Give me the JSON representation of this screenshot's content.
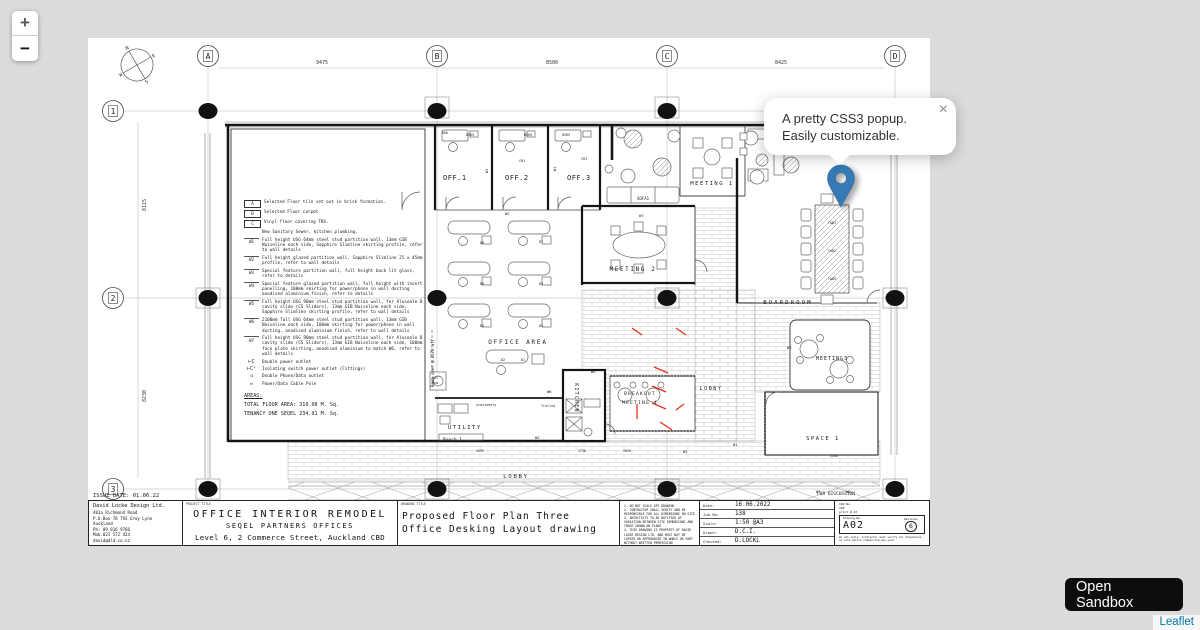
{
  "colors": {
    "map_bg": "#dcdcdc",
    "marker": "#3579b5",
    "attribution_link": "#0078A8",
    "red_mark": "#e8311a"
  },
  "ui": {
    "zoom_in": "+",
    "zoom_out": "−",
    "popup": {
      "line1": "A pretty CSS3 popup.",
      "line2": "Easily customizable.",
      "close": "×"
    },
    "sandbox_label": "Open Sandbox",
    "attribution": "Leaflet"
  },
  "plan": {
    "grid": {
      "cols": [
        {
          "label": "A",
          "x": 120
        },
        {
          "label": "B",
          "x": 349
        },
        {
          "label": "C",
          "x": 579
        },
        {
          "label": "D",
          "x": 807
        }
      ],
      "rows": [
        {
          "label": "1",
          "y": 73
        },
        {
          "label": "2",
          "y": 260
        },
        {
          "label": "3",
          "y": 451
        }
      ],
      "col_dims": [
        {
          "text": "9475",
          "x": 234
        },
        {
          "text": "8500",
          "x": 464
        },
        {
          "text": "8425",
          "x": 693
        }
      ],
      "row_dims": [
        {
          "text": "8115",
          "y": 167
        },
        {
          "text": "8230",
          "y": 358
        }
      ]
    },
    "compass": {
      "n": "N",
      "e": "E",
      "s": "S",
      "w": "W"
    },
    "labels": [
      {
        "t": "OFF.1",
        "x": 355,
        "y": 142,
        "s": 7,
        "ls": 0.5
      },
      {
        "t": "OFF.2",
        "x": 417,
        "y": 142,
        "s": 7,
        "ls": 0.5
      },
      {
        "t": "OFF.3",
        "x": 479,
        "y": 142,
        "s": 7,
        "ls": 0.5
      },
      {
        "t": "MEETING 1",
        "x": 624,
        "y": 147,
        "s": 5.5,
        "ls": 1.5,
        "a": "middle"
      },
      {
        "t": "SOFA1",
        "x": 549,
        "y": 162,
        "s": 4
      },
      {
        "t": "MEETING 2",
        "x": 545,
        "y": 233,
        "s": 6,
        "ls": 1.6,
        "a": "middle"
      },
      {
        "t": "OFFICE AREA",
        "x": 430,
        "y": 306,
        "s": 6,
        "ls": 1.8,
        "a": "middle"
      },
      {
        "t": "KITCHEN",
        "x": 487,
        "y": 360,
        "s": 5,
        "ls": 1.2,
        "r": 90,
        "a": "middle"
      },
      {
        "t": "BREAKOUT",
        "x": 552,
        "y": 357,
        "s": 4.6,
        "ls": 1.2,
        "a": "middle"
      },
      {
        "t": "MEETING 4",
        "x": 552,
        "y": 366,
        "s": 4.6,
        "ls": 1.2,
        "a": "middle"
      },
      {
        "t": "LOBBY",
        "x": 623,
        "y": 352,
        "s": 5,
        "ls": 1.6,
        "a": "middle"
      },
      {
        "t": "LOBBY",
        "x": 428,
        "y": 440,
        "s": 5.5,
        "ls": 1.8,
        "a": "middle"
      },
      {
        "t": "UTILITY",
        "x": 360,
        "y": 391,
        "s": 5.5,
        "ls": 1.5
      },
      {
        "t": "Bench 1",
        "x": 355,
        "y": 403,
        "s": 4.5
      },
      {
        "t": "BOARDROOM",
        "x": 700,
        "y": 266,
        "s": 5.5,
        "ls": 2.2,
        "a": "middle"
      },
      {
        "t": "MEETING3",
        "x": 744,
        "y": 322,
        "s": 5,
        "ls": 1,
        "a": "middle"
      },
      {
        "t": "SPACE 1",
        "x": 735,
        "y": 402,
        "s": 5.5,
        "ls": 1.5,
        "a": "middle"
      },
      {
        "t": "ISSUE DATE: 01.06.22",
        "x": 5,
        "y": 459,
        "s": 5.5
      },
      {
        "t": "FOR DISCUSSION",
        "x": 748,
        "y": 457,
        "s": 4.5,
        "a": "middle"
      },
      {
        "t": "Beam over @ 2670 aff",
        "x": 346,
        "y": 325,
        "s": 4,
        "r": -90,
        "a": "middle"
      },
      {
        "t": "DSK5",
        "x": 378,
        "y": 98,
        "s": 3.4
      },
      {
        "t": "DSK5",
        "x": 436,
        "y": 98,
        "s": 3.4
      },
      {
        "t": "DSK5",
        "x": 474,
        "y": 98,
        "s": 3.4
      },
      {
        "t": "CH1",
        "x": 431,
        "y": 124,
        "s": 3.4
      },
      {
        "t": "CH1",
        "x": 493,
        "y": 122,
        "s": 3.4
      },
      {
        "t": "D6",
        "x": 392,
        "y": 206,
        "s": 3.4
      },
      {
        "t": "D7",
        "x": 451,
        "y": 205,
        "s": 3.4
      },
      {
        "t": "D8",
        "x": 392,
        "y": 247,
        "s": 3.4
      },
      {
        "t": "D5",
        "x": 451,
        "y": 247,
        "s": 3.4
      },
      {
        "t": "D4",
        "x": 392,
        "y": 289,
        "s": 3.4
      },
      {
        "t": "D3",
        "x": 451,
        "y": 289,
        "s": 3.4
      },
      {
        "t": "D2",
        "x": 413,
        "y": 323,
        "s": 3.4
      },
      {
        "t": "D1",
        "x": 433,
        "y": 323,
        "s": 3.4
      },
      {
        "t": "TAB1",
        "x": 744,
        "y": 186,
        "s": 3.4,
        "a": "middle"
      },
      {
        "t": "TAB2",
        "x": 744,
        "y": 214,
        "s": 3.4,
        "a": "middle"
      },
      {
        "t": "TAB3",
        "x": 744,
        "y": 242,
        "s": 3.4,
        "a": "middle"
      },
      {
        "t": "Cal",
        "x": 344,
        "y": 341,
        "s": 3.4
      },
      {
        "t": "Pod",
        "x": 344,
        "y": 346,
        "s": 3.4
      },
      {
        "t": "stationery",
        "x": 388,
        "y": 368,
        "s": 3.4
      },
      {
        "t": "Trolley",
        "x": 453,
        "y": 369,
        "s": 3.4
      },
      {
        "t": "W1",
        "x": 400,
        "y": 133,
        "s": 3.8,
        "r": -90,
        "a": "middle"
      },
      {
        "t": "W1",
        "x": 468,
        "y": 131,
        "s": 3.8,
        "r": -90,
        "a": "middle"
      },
      {
        "t": "W2",
        "x": 417,
        "y": 177,
        "s": 3.8
      },
      {
        "t": "W7",
        "x": 551,
        "y": 179,
        "s": 3.8
      },
      {
        "t": "W5",
        "x": 503,
        "y": 335,
        "s": 3.8
      },
      {
        "t": "W6",
        "x": 459,
        "y": 355,
        "s": 3.8
      },
      {
        "t": "W2",
        "x": 447,
        "y": 401,
        "s": 3.8
      },
      {
        "t": "W2",
        "x": 595,
        "y": 415,
        "s": 3.8
      },
      {
        "t": "W1",
        "x": 645,
        "y": 408,
        "s": 3.8
      },
      {
        "t": "W2",
        "x": 699,
        "y": 311,
        "s": 3.8
      },
      {
        "t": "W1",
        "x": 728,
        "y": 455,
        "s": 3.8
      },
      {
        "t": "W2",
        "x": 758,
        "y": 455,
        "s": 3.8
      },
      {
        "t": "800",
        "x": 354,
        "y": 96,
        "s": 3.2
      },
      {
        "t": "2020",
        "x": 535,
        "y": 414,
        "s": 3.2
      },
      {
        "t": "2440",
        "x": 742,
        "y": 419,
        "s": 3.2
      },
      {
        "t": "4495",
        "x": 388,
        "y": 414,
        "s": 3.2
      },
      {
        "t": "1730",
        "x": 490,
        "y": 414,
        "s": 3.2
      }
    ],
    "red_marks": [
      [
        544,
        290,
        554,
        297
      ],
      [
        588,
        290,
        598,
        297
      ],
      [
        566,
        329,
        580,
        335
      ],
      [
        564,
        348,
        578,
        354
      ],
      [
        564,
        365,
        578,
        371
      ],
      [
        549,
        366,
        549,
        381
      ],
      [
        572,
        384,
        584,
        392
      ],
      [
        588,
        372,
        596,
        366
      ]
    ]
  },
  "legend": {
    "rows": [
      {
        "sym": "A",
        "kind": "box",
        "text": "Selected Floor tile set out in brick formation."
      },
      {
        "sym": "B",
        "kind": "box",
        "text": "Selected Floor carpet"
      },
      {
        "sym": "C",
        "kind": "box",
        "text": "Vinyl floor covering TBS."
      },
      {
        "sym": "",
        "kind": "none",
        "text": "New Sanitary Sewer, kitchen plumbing."
      },
      {
        "sym": "W1",
        "kind": "wall",
        "text": "Full height USG 64mm steel stud partition wall, 13mm GIB Noiseline each side, Sapphire Slimline skirting profile, refer to wall details"
      },
      {
        "sym": "W2",
        "kind": "wall",
        "text": "Full height glazed partition wall, Sapphire Slimline 25 x 45mm profile, refer to wall details"
      },
      {
        "sym": "W3",
        "kind": "wall",
        "text": "Special feature partition wall, full height back lit glass, refer to details"
      },
      {
        "sym": "W4",
        "kind": "wall",
        "text": "Special feature glazed partition wall, full height with insert panelling, 100mm skirting for power/phone in wall ducting anodised aluminium finish, refer to details"
      },
      {
        "sym": "W5",
        "kind": "wall",
        "text": "Full height USG 90mm steel stud partition wall, for Aluseale D cavity slide (CS Sliders), 13mm GIB Noiseline each side, Sapphire Slimline skirting profile, refer to wall details"
      },
      {
        "sym": "W6",
        "kind": "wall",
        "text": "2100mm Tall USG 64mm steel stud partition wall, 13mm GIB Noiseline each side, 100mm skirting for power/phone in wall ducting, anodised aluminium finish, refer to wall details"
      },
      {
        "sym": "W7",
        "kind": "wall",
        "text": "Full height USG 90mm steel stud partition wall, for Aluseale D cavity slide (CS Sliders), 13mm GIB Noiseline each side, 100mm face plate skirting, anodised aluminium to match W6, refer to wall details"
      },
      {
        "sym": "⊢C",
        "kind": "pwr",
        "text": "Double power outlet"
      },
      {
        "sym": "⊢Cˢ",
        "kind": "pwr",
        "text": "Isolating switch power outlet (Fittings)"
      },
      {
        "sym": "◁",
        "kind": "pwr",
        "text": "Double Phone/Data outlet"
      },
      {
        "sym": "▭",
        "kind": "pwr",
        "text": "Power/Data Cable Pole"
      }
    ],
    "areas_title": "AREAS:",
    "areas": [
      "TOTAL FLOOR AREA:   310.08 M. Sq.",
      "TENANCY ONE  SEQEL  234.91 M. Sq."
    ]
  },
  "titleblock": {
    "designer": {
      "name": "David Locke Design  Ltd.",
      "lines": [
        "401a Richmond Road",
        "P.O.Box 78 793 Grey Lynn",
        "Auckland",
        "Ph:   09 816 9766",
        "Mob.021 572 424",
        "david@dld.co.nz"
      ]
    },
    "project": {
      "label": "PROJECT TITLE",
      "title": "OFFICE  INTERIOR  REMODEL",
      "subtitle": "SEQEL  PARTNERS  OFFICES",
      "address": "Level 6, 2 Commerce Street, Auckland CBD"
    },
    "drawing": {
      "label": "DRAWING TITLE",
      "line1": "Proposed  Floor  Plan  Three",
      "line2": "Office  Desking  Layout  drawing"
    },
    "notes": [
      "1. DO NOT SCALE OFF DRAWING",
      "2. CONTRACTOR SHALL VERIFY AND BE RESPONSIBLE FOR ALL DIMENSIONS ON SITE",
      "3. ARCHITECTS TO BE NOTIFIED OF VARIATION BETWEEN SITE DIMENSIONS AND THOSE SHOWN ON PLANS",
      "4. THIS DRAWING IS PROPERTY OF DAVID LOCKE DESIGN LTD. AND MUST NOT BE COPIED OR REPRODUCED IN WHOLE OR PART WITHOUT WRITTEN PERMISSION"
    ],
    "meta": [
      {
        "label": "Date:",
        "value": "16.06.2022"
      },
      {
        "label": "Job No:",
        "value": "138"
      },
      {
        "label": "Scale:",
        "value": "1:50  @A3"
      },
      {
        "label": "Drawn:",
        "value": "D.C.I."
      },
      {
        "label": "Checked:",
        "value": "D.LOCKL"
      }
    ],
    "dwg": {
      "cad_lines": [
        "CAD No.",
        "138",
        "print @ A3"
      ],
      "no_label": "Drawing No.",
      "number": "A02",
      "rev_label": "Revision",
      "revision": "6",
      "fine_print": "Do not scale. Contractor must verify all dimensions on site before commencing any work."
    }
  }
}
